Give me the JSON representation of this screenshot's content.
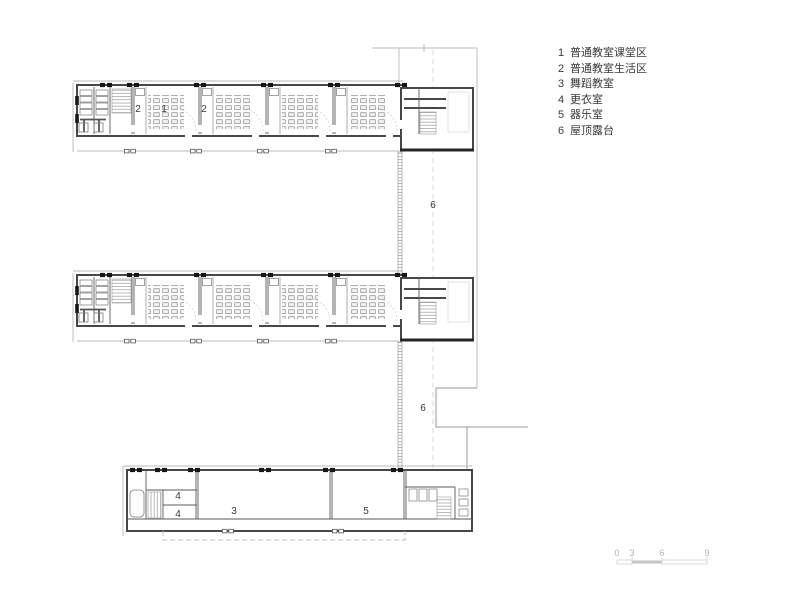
{
  "legend": {
    "items": [
      {
        "num": "1",
        "label": "普通教室课堂区"
      },
      {
        "num": "2",
        "label": "普通教室生活区"
      },
      {
        "num": "3",
        "label": "舞蹈教室"
      },
      {
        "num": "4",
        "label": "更衣室"
      },
      {
        "num": "5",
        "label": "器乐室"
      },
      {
        "num": "6",
        "label": "屋顶露台"
      }
    ]
  },
  "plan": {
    "room_labels": [
      {
        "room": "living-area-left",
        "text": "2"
      },
      {
        "room": "classroom-teaching-area",
        "text": "1"
      },
      {
        "room": "living-area-right",
        "text": "2"
      },
      {
        "room": "roof-terrace-upper",
        "text": "6"
      },
      {
        "room": "roof-terrace-lower",
        "text": "6"
      },
      {
        "room": "changing-room-upper",
        "text": "4"
      },
      {
        "room": "changing-room-lower",
        "text": "4"
      },
      {
        "room": "dance-studio",
        "text": "3"
      },
      {
        "room": "instrumental-music-room",
        "text": "5"
      }
    ]
  },
  "scalebar": {
    "ticks": [
      "0",
      "3",
      "6",
      "9"
    ]
  },
  "colors": {
    "background": "#ffffff",
    "wall": "#474747",
    "heavy_wall": "#262626",
    "thin_line": "#b8b8b8",
    "column_mark": "#161616",
    "label_text": "#3a3a3a",
    "scale_gray": "#c6c6c6"
  }
}
